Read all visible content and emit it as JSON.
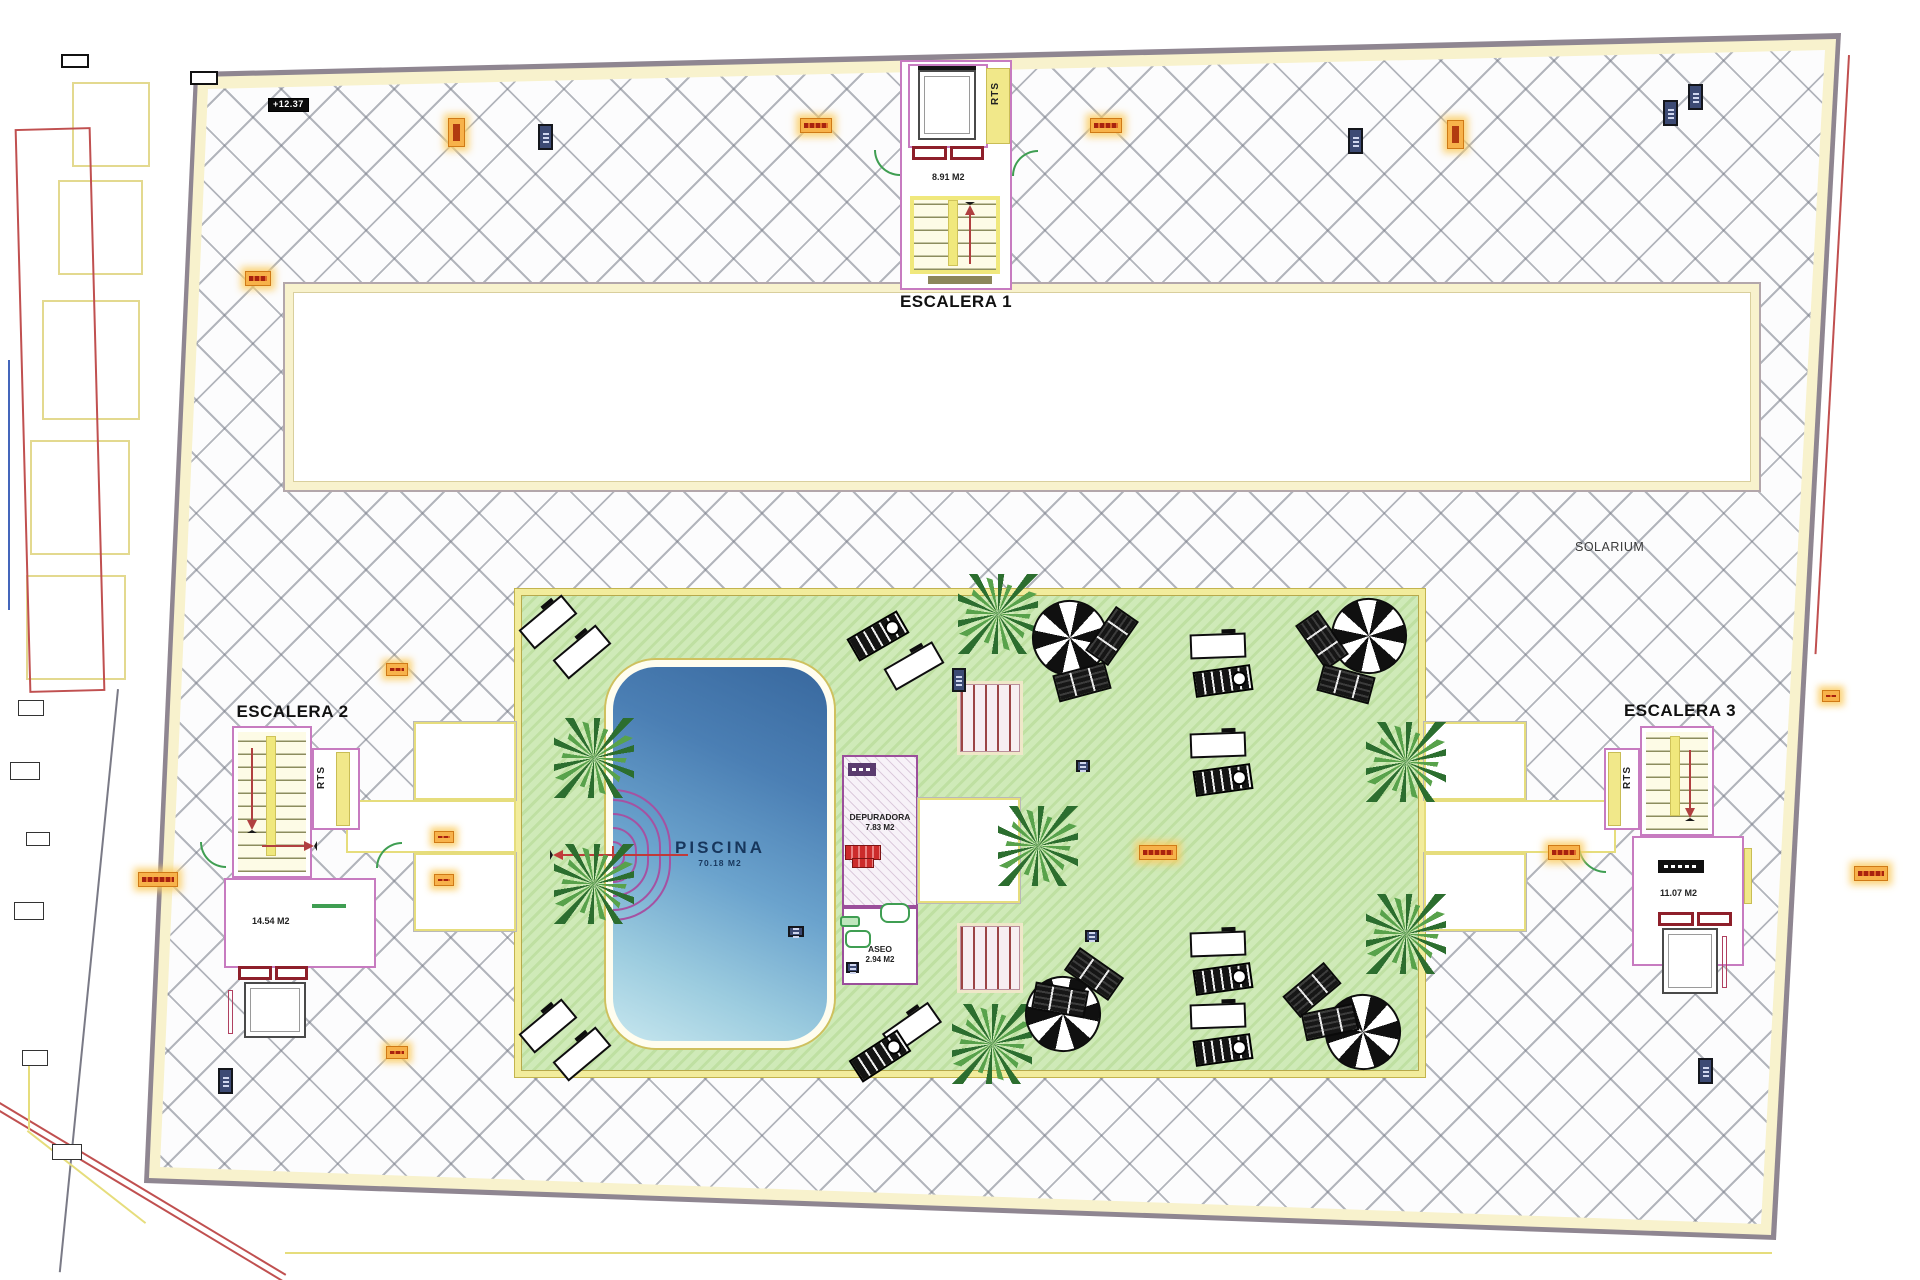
{
  "plan": {
    "stairs": {
      "escalera1": {
        "title": "ESCALERA 1",
        "area": "8.91 M2",
        "shaft_label": "RTS"
      },
      "escalera2": {
        "title": "ESCALERA 2",
        "area": "14.54 M2",
        "shaft_label": "RTS"
      },
      "escalera3": {
        "title": "ESCALERA 3",
        "area": "11.07 M2",
        "shaft_label": "RTS"
      }
    },
    "pool": {
      "title": "PISCINA",
      "area": "70.18 M2"
    },
    "rooms": {
      "depuradora": {
        "title": "DEPURADORA",
        "area": "7.83 M2"
      },
      "aseo": {
        "title": "ASEO",
        "area": "2.94 M2"
      }
    },
    "zones": {
      "solarium": "SOLARIUM"
    },
    "markers": {
      "elevation_top_left": "+12.37"
    },
    "icons": {
      "palm-tree-icon": "green conic burst",
      "parasol-icon": "black/white pinwheel circle",
      "sun-lounger-black-icon": "black striped rectangle",
      "sun-lounger-white-icon": "white outlined rectangle",
      "lift-doors-icon": "double red door rectangles",
      "stair-arrow-icon": "red line with triangular head",
      "door-swing-icon": "green quarter-circle arc",
      "elevation-marker-icon": "black badge with white text",
      "drain-marker-orange-icon": "orange glowing badge",
      "vent-marker-navy-icon": "navy badge",
      "pool-steps-icon": "concentric purple arcs",
      "wood-walkway-icon": "red plank strip"
    },
    "colors": {
      "pool_blue": "#4b7fb4",
      "deck_green": "#cfeab8",
      "deck_border_yellow": "#f2ec9c",
      "hatch_line_gray": "#767b87",
      "wall_purple": "#c77bc0",
      "lift_red": "#8e1f2a",
      "palm_green": "#2c6e2f",
      "umbrella_black": "#101010",
      "marker_orange": "#f7b24a",
      "marker_navy": "#3c4a74",
      "cream_border": "#f8f2cd"
    }
  }
}
